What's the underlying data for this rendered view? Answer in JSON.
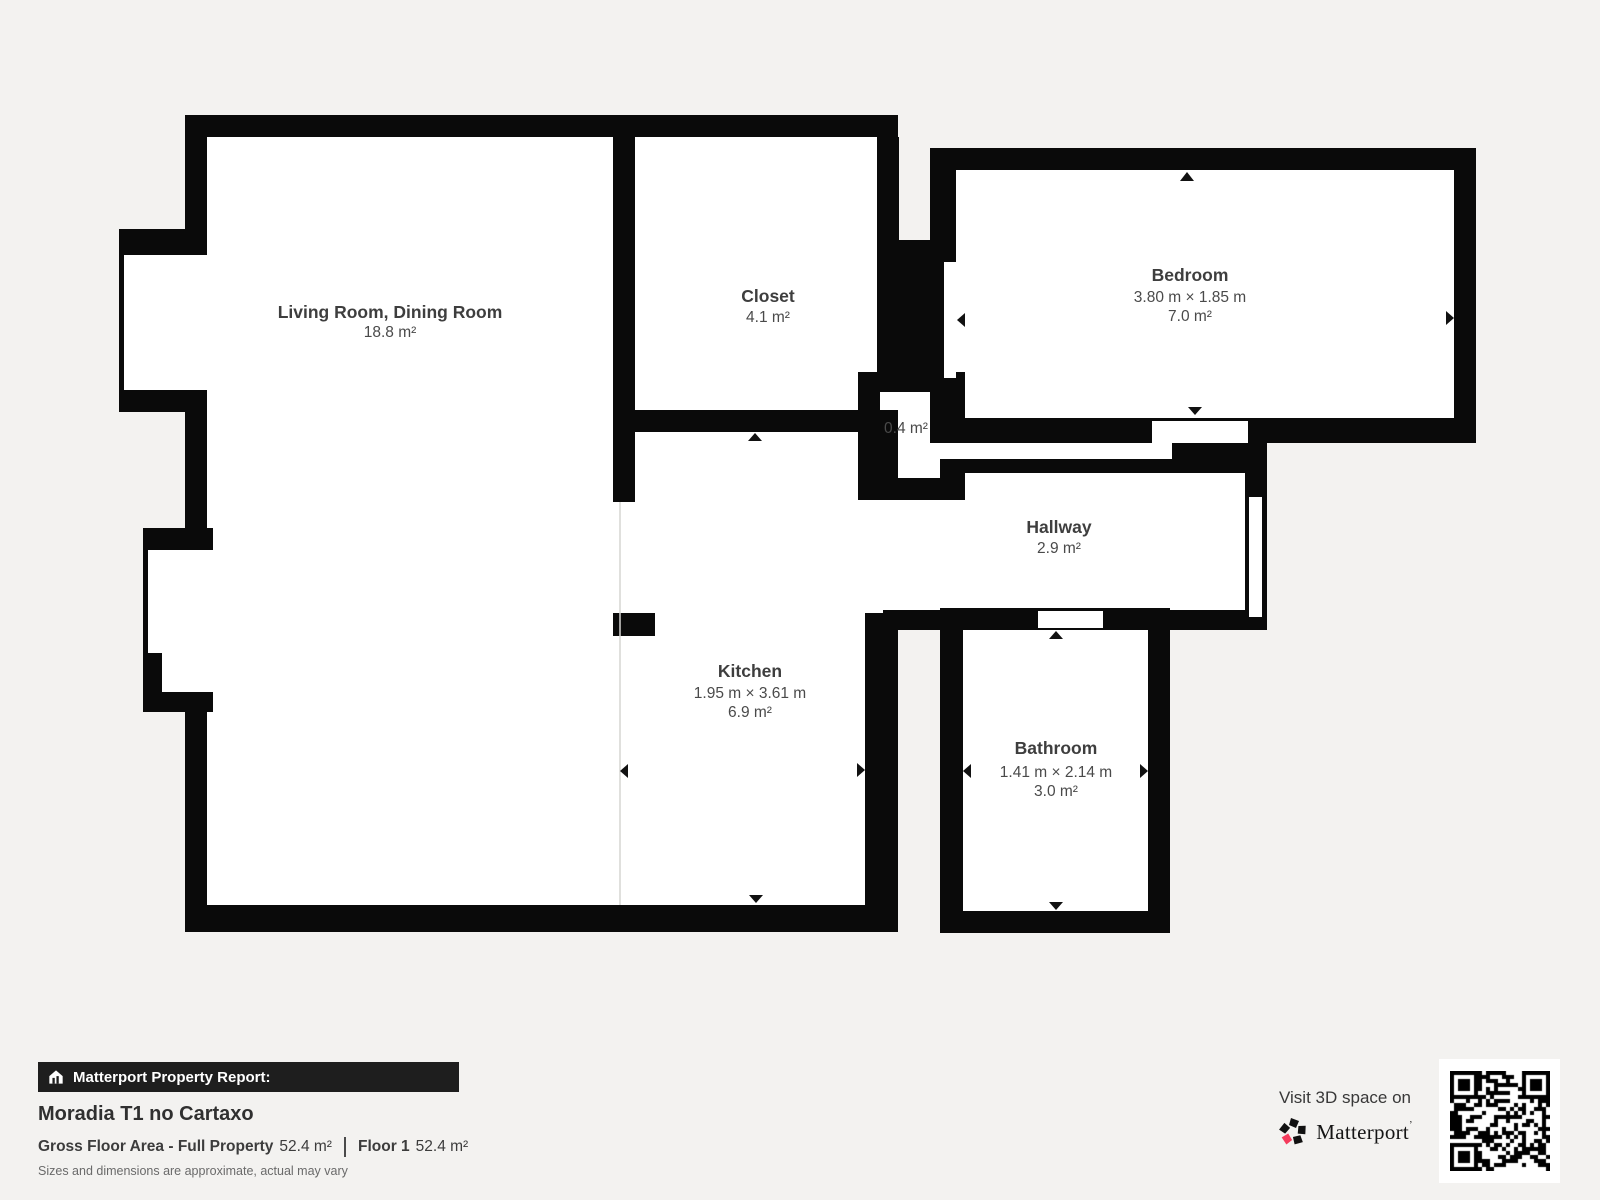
{
  "floorplan": {
    "rooms": [
      {
        "id": "living",
        "name": "Living Room, Dining Room",
        "area": "18.8 m²"
      },
      {
        "id": "closet",
        "name": "Closet",
        "area": "4.1 m²"
      },
      {
        "id": "bedroom",
        "name": "Bedroom",
        "dims": "3.80 m × 1.85 m",
        "area": "7.0 m²"
      },
      {
        "id": "vestibule",
        "area": "0.4 m²"
      },
      {
        "id": "hallway",
        "name": "Hallway",
        "area": "2.9 m²"
      },
      {
        "id": "kitchen",
        "name": "Kitchen",
        "dims": "1.95 m × 3.61 m",
        "area": "6.9 m²"
      },
      {
        "id": "bathroom",
        "name": "Bathroom",
        "dims": "1.41 m × 2.14 m",
        "area": "3.0 m²"
      }
    ]
  },
  "report": {
    "badge": "Matterport Property Report:",
    "property_title": "Moradia T1 no Cartaxo",
    "gross_label": "Gross Floor Area - Full Property",
    "gross_value": "52.4 m²",
    "floor_label": "Floor 1",
    "floor_value": "52.4 m²",
    "disclaimer": "Sizes and dimensions are approximate, actual may vary"
  },
  "promo": {
    "visit": "Visit 3D space on",
    "brand": "Matterport",
    "brand_mark": "’"
  },
  "icons": {
    "badge_icon": "house-report-icon",
    "logo_icon": "matterport-pinwheel-icon",
    "qr": "qr-code"
  },
  "colors": {
    "background": "#f3f2f0",
    "wall": "#0a0a0a",
    "floor": "#ffffff",
    "text": "#3e3e3e",
    "brand_accent": "#f43b5c",
    "badge_bg": "#1e1e1e"
  }
}
